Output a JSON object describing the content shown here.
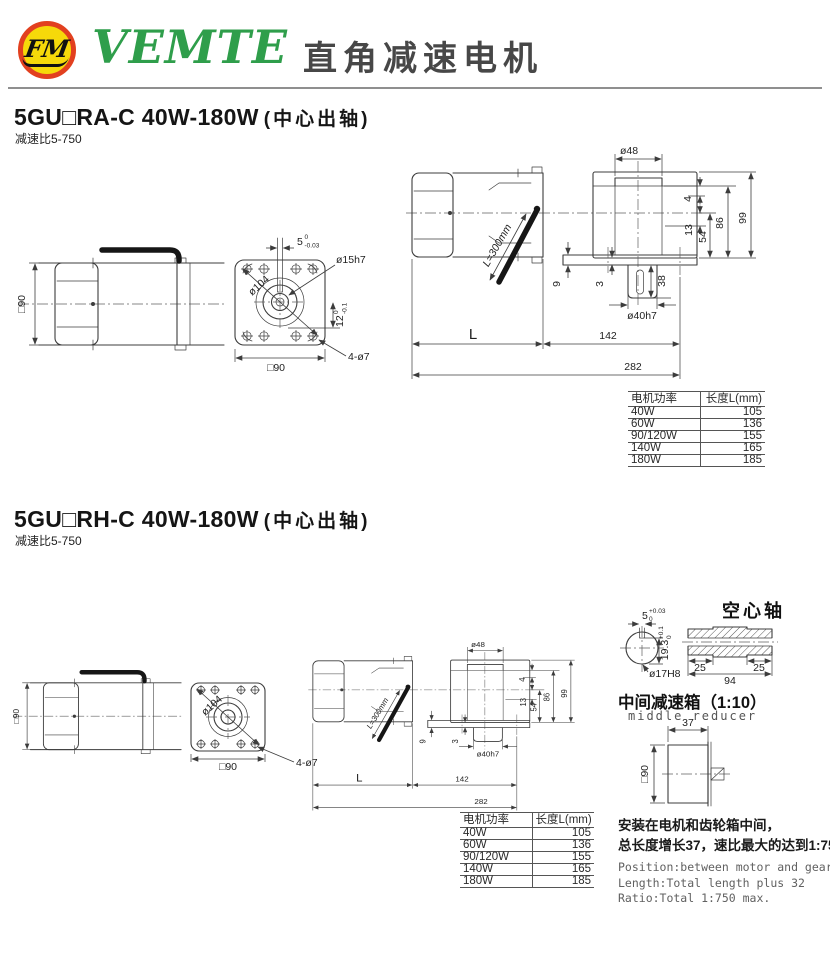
{
  "header": {
    "logo_text": "FM",
    "brand": "VEMTE",
    "title": "直角减速电机"
  },
  "section1": {
    "title": "5GU□RA-C 40W-180W",
    "title_paren": "(中心出轴)",
    "subtitle": "减速比5-750",
    "side_view": {
      "frame_size": "□90"
    },
    "flange_view": {
      "key_width": "5",
      "key_width_tol_up": "0",
      "key_width_tol_low": "-0.03",
      "shaft_dia": "ø15h7",
      "bolt_circle_dia": "ø104",
      "frame_size": "□90",
      "key_height": "12",
      "key_height_tol_up": "0",
      "key_height_tol_low": "-0.1",
      "mount_holes": "4-ø7"
    },
    "top_view": {
      "boss_dia": "ø48",
      "dim_4": "4",
      "dim_13": "13",
      "dim_54": "54",
      "dim_86": "86",
      "dim_99": "99",
      "dim_9": "9",
      "dim_3": "3",
      "dim_38": "38",
      "shaft_dia": "ø40h7",
      "cable_length": "L=300mm",
      "dim_L": "L",
      "dim_142": "142",
      "dim_282": "282"
    },
    "table": {
      "col_power": "电机功率",
      "col_length": "长度L(mm)",
      "rows": [
        {
          "power": "40W",
          "length": "105"
        },
        {
          "power": "60W",
          "length": "136"
        },
        {
          "power": "90/120W",
          "length": "155"
        },
        {
          "power": "140W",
          "length": "165"
        },
        {
          "power": "180W",
          "length": "185"
        }
      ]
    }
  },
  "section2": {
    "title": "5GU□RH-C 40W-180W",
    "title_paren": "(中心出轴)",
    "subtitle": "减速比5-750",
    "side_view": {
      "frame_size": "□90"
    },
    "flange_view": {
      "bolt_circle_dia": "ø104",
      "frame_size": "□90",
      "mount_holes": "4-ø7"
    },
    "top_view": {
      "boss_dia": "ø48",
      "dim_4": "4",
      "dim_13": "13",
      "dim_54": "54",
      "dim_86": "86",
      "dim_99": "99",
      "dim_9": "9",
      "dim_3": "3",
      "shaft_dia": "ø40h7",
      "cable_length": "L=300mm",
      "dim_L": "L",
      "dim_142": "142",
      "dim_282": "282"
    },
    "hollow_shaft": {
      "title": "空心轴",
      "key_width": "5",
      "key_width_tol_up": "+0.03",
      "key_width_tol_low": "0",
      "key_depth": "19.3",
      "key_depth_tol_up": "+0.1",
      "key_depth_tol_low": "0",
      "bore_dia": "ø17H8",
      "dim_25_left": "25",
      "dim_94": "94",
      "dim_25_right": "25"
    },
    "middle_reducer": {
      "title": "中间减速箱（1:10）",
      "subtitle": "middle reducer",
      "dim_37": "37",
      "frame_size": "□90"
    },
    "table": {
      "col_power": "电机功率",
      "col_length": "长度L(mm)",
      "rows": [
        {
          "power": "40W",
          "length": "105"
        },
        {
          "power": "60W",
          "length": "136"
        },
        {
          "power": "90/120W",
          "length": "155"
        },
        {
          "power": "140W",
          "length": "165"
        },
        {
          "power": "180W",
          "length": "185"
        }
      ]
    },
    "notes": {
      "cn_line1": "安装在电机和齿轮箱中间，",
      "cn_line2": "总长度增长37，速比最大的达到1:750",
      "en_line1": "Position:between motor and gearbox",
      "en_line2": "Length:Total length plus 32",
      "en_line3": "Ratio:Total 1:750 max."
    }
  }
}
